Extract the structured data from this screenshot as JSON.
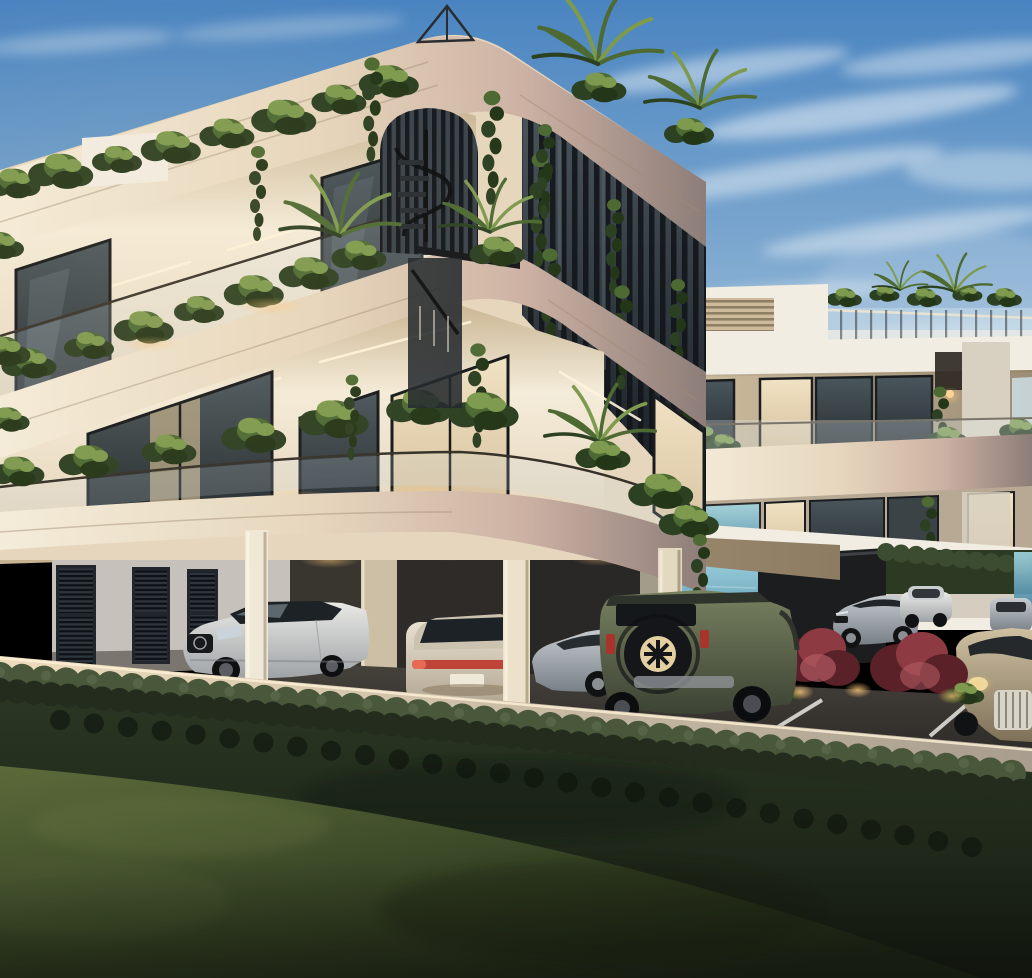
{
  "window": {
    "width": 1032,
    "height": 978
  },
  "scene": {
    "kind": "architectural-exterior-render",
    "time_of_day": "dusk",
    "main_building": {
      "storeys": 3,
      "louver_doors": 3,
      "features": [
        "rounded-corner fascia bands",
        "rooftop garden planting",
        "vertical louver screen with climbing ivy",
        "spiral staircase behind arched louvers",
        "glass balustrade balconies",
        "under-building parking"
      ]
    },
    "secondary_building": {
      "storeys": 3,
      "features": [
        "roof terrace with glass railing",
        "curtained glass balconies",
        "outdoor dining furniture",
        "parking canopy with columns"
      ]
    },
    "vehicles": {
      "count": 7,
      "list": [
        "white luxury sedan front view",
        "pearl sedan rear view with lit tail-lamp bar",
        "silver sedan side view",
        "olive-green off-road SUV with spare wheel",
        "silver sports sedan",
        "white compact car",
        "beige luxury sedan with chrome grille"
      ]
    },
    "landscape": [
      "clipped dark hedge",
      "lawn",
      "ornamental red bushes",
      "sea glimpse between columns",
      "white parking bay lines",
      "path uplights"
    ]
  },
  "colors": {
    "sky_top": "#4a84c0",
    "sky_mid": "#7ea9d0",
    "sky_low": "#bccfe0",
    "cloud_white": "#e9f0f6",
    "sea_light": "#a5d8e2",
    "sea_deep": "#3f7fa0",
    "cream_light": "#f4ecda",
    "cream_mid": "#e6d6bd",
    "band_pink": "#cdb2a4",
    "band_dark": "#8d7d78",
    "ceiling_warm": "#c8b492",
    "ceiling_deep": "#8d7c62",
    "wall_gray": "#c6c1ba",
    "wall_dark": "#8f8a83",
    "glass_dark": "#272d31",
    "glass_mid": "#49565c",
    "glass_tint": "#cfdde4",
    "curtain_light": "#f0e2c4",
    "curtain_deep": "#d6c09c",
    "interior_glow": "#e7cf9e",
    "screen_top": "#4a545c",
    "screen_bg": "#2b3339",
    "slat_dark": "#11151a",
    "frame_dark": "#1a1d20",
    "rail_dark": "#35312a",
    "groove": "#a08b74",
    "led_warm": "#fff4dc",
    "plant_dark": "#2c4022",
    "plant_mid": "#4d6a33",
    "plant_light": "#7d9a4e",
    "vine_dark": "#243618",
    "hedge_light": "#49573a",
    "hedge_mid": "#2c3824",
    "hedge_dark": "#161c12",
    "lawn_light": "#5c6a3a",
    "lawn_mid": "#3b4827",
    "lawn_dark": "#1e2615",
    "asphalt_mid": "#46423c",
    "asphalt_dark": "#262422",
    "concrete_light": "#958b79",
    "concrete_deep": "#57514a",
    "curb_light": "#eddcbd",
    "curb_shadow": "#a89d8e",
    "line_white": "#e8e6e0",
    "car_white": "#e9e9e6",
    "car_white_shadow": "#9fa3a6",
    "car_pearl": "#e8e0d0",
    "car_pearl_shadow": "#b3a894",
    "car_suv_light": "#788160",
    "car_suv_dark": "#3c4334",
    "car_silver_light": "#c6cbd0",
    "car_silver_dark": "#787f86",
    "car_beige_light": "#cfc0a2",
    "car_beige_dark": "#7e7158",
    "taillight_red": "#c04338",
    "wheel_dark": "#101213",
    "rim_gray": "#8b9094",
    "rim_lit": "#e3cfa0",
    "bush_red": "#8e3a42",
    "bush_red_dark": "#5a2128",
    "light_warm": "#ffc97a",
    "sun_glow": "#ffd9a0",
    "sec_white": "#f2ede2",
    "sec_shadow": "#d8d0c0",
    "sec_recess": "#cfc0a8",
    "dark_wall": "#1b1d1f",
    "tree_green": "#2c3a24"
  }
}
